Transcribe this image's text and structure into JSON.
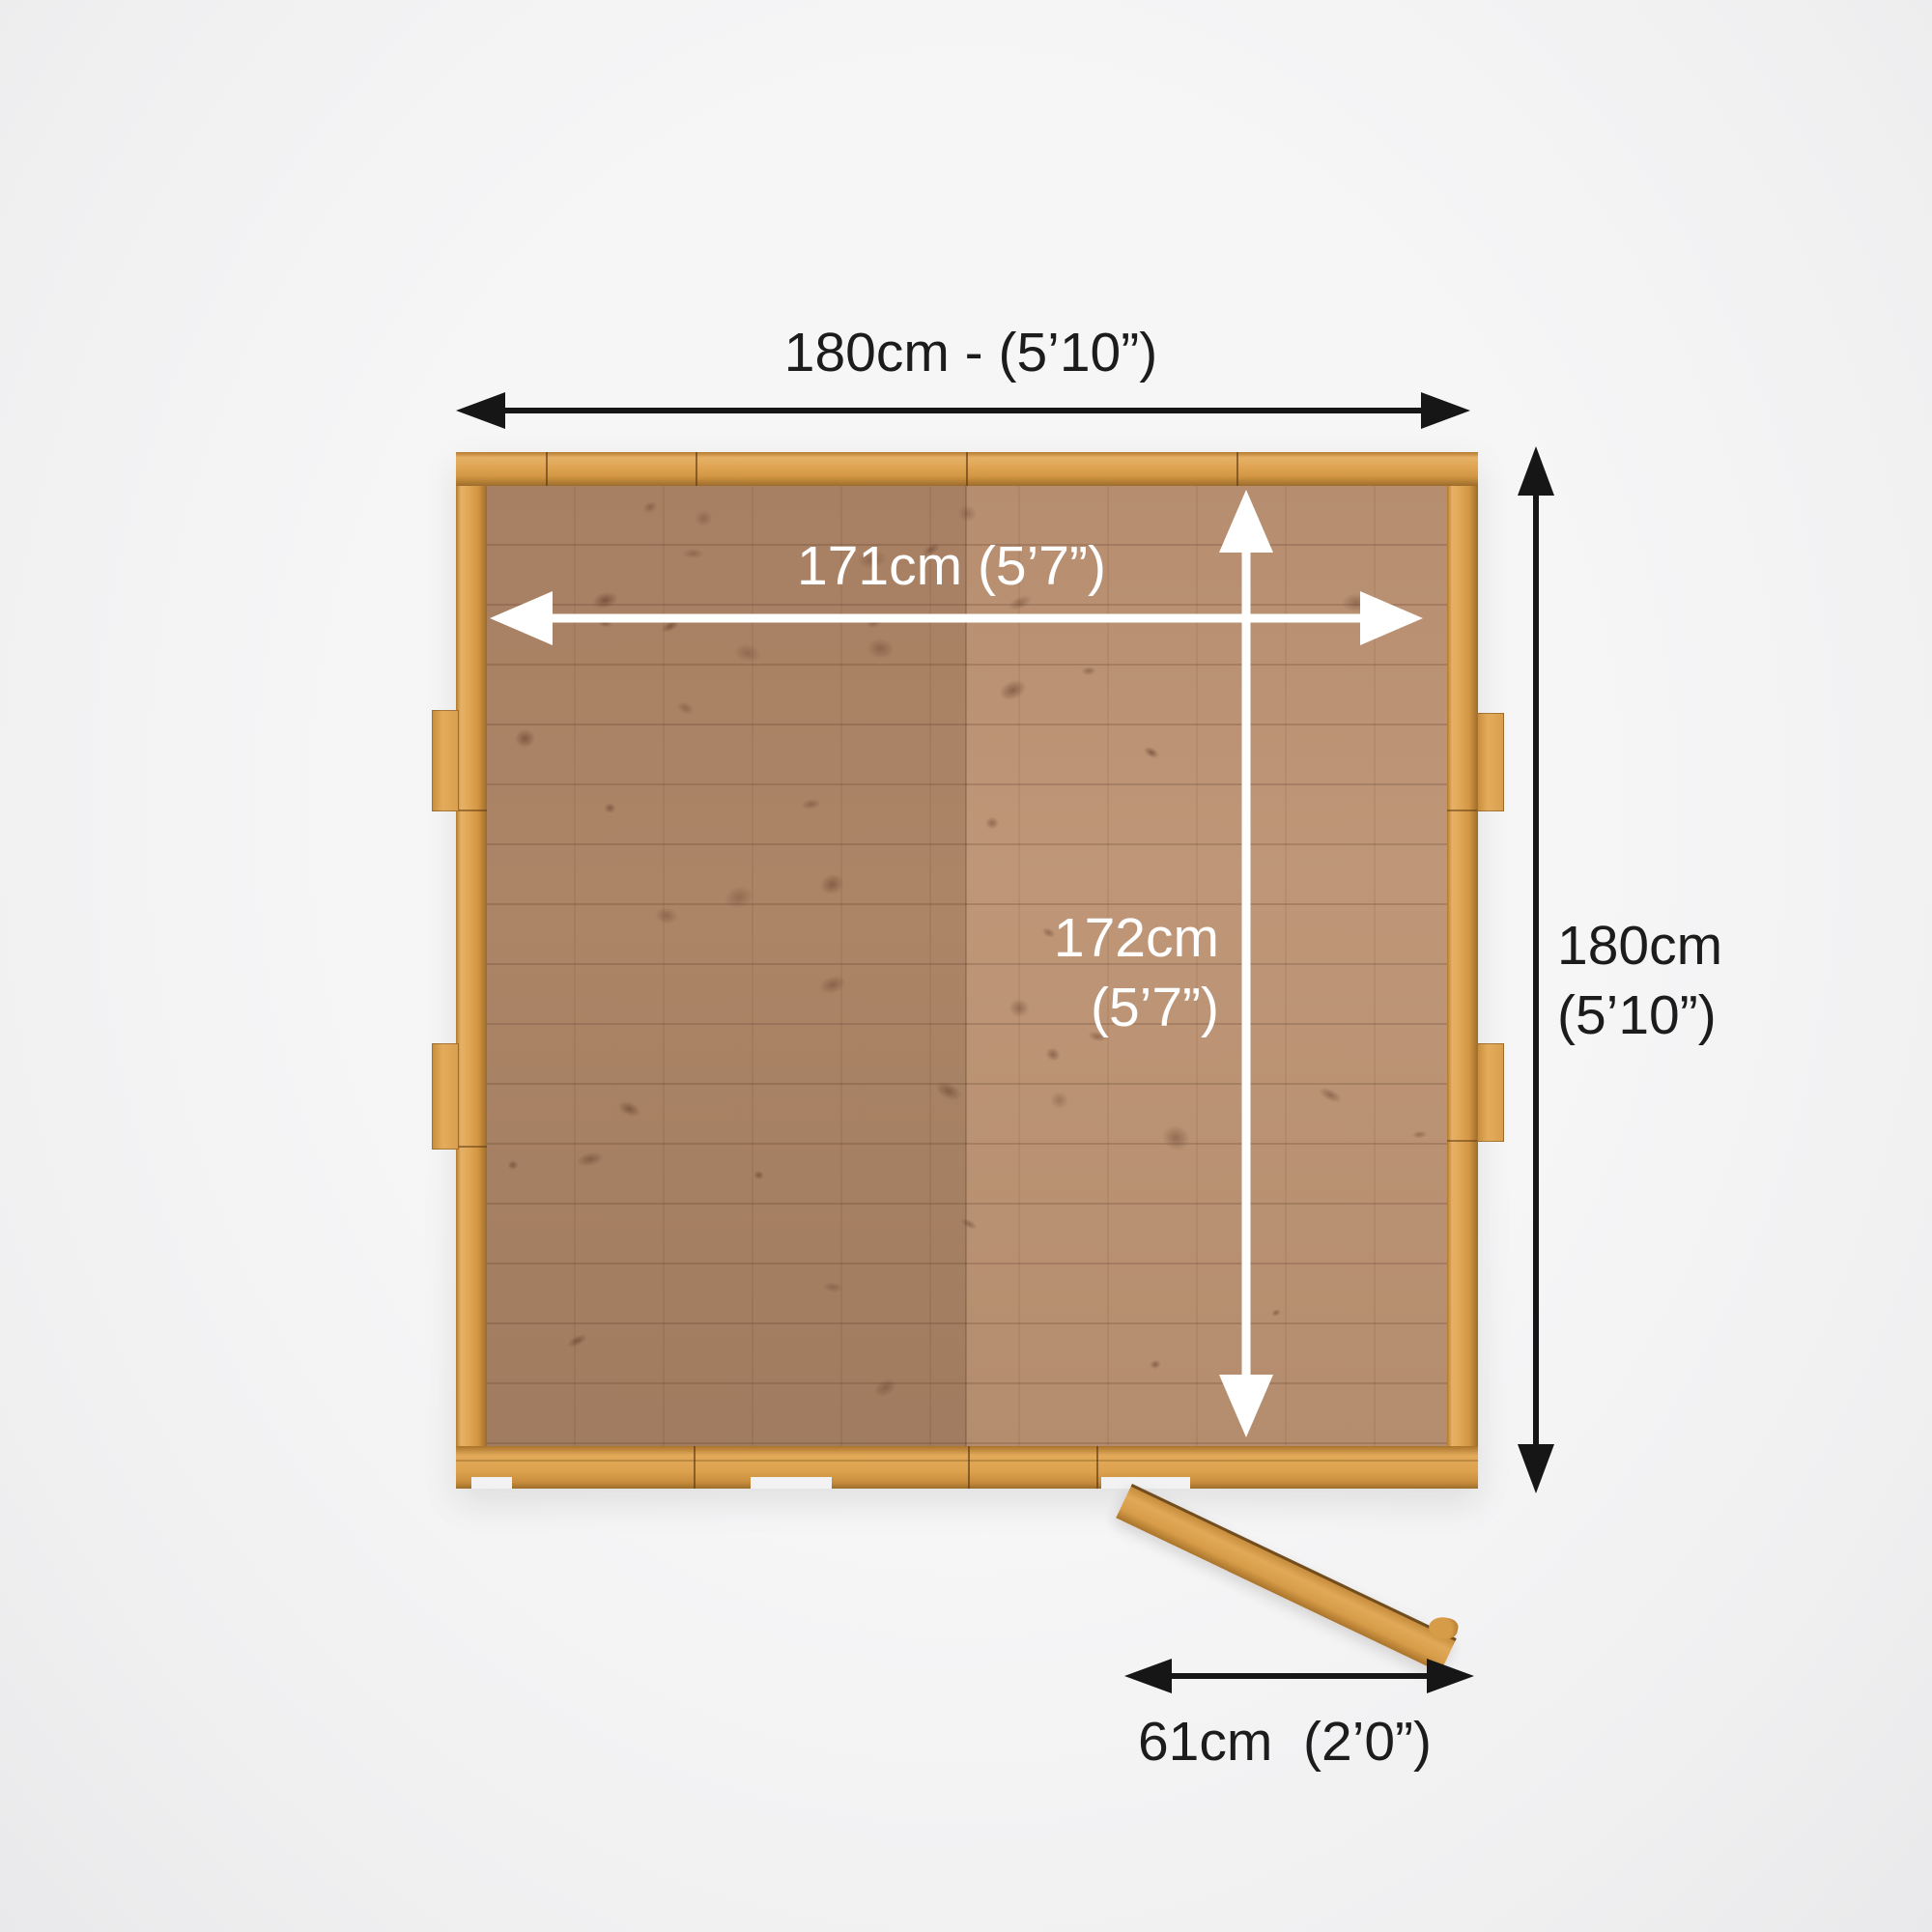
{
  "labels": {
    "outer_width": "180cm - (5’10”)",
    "outer_depth_line1": "180cm",
    "outer_depth_line2": "(5’10”)",
    "inner_width": "171cm (5’7”)",
    "inner_depth_line1": "172cm",
    "inner_depth_line2": "(5’7”)",
    "door_width": "61cm  (2’0”)"
  },
  "colors": {
    "background": "#f2f2f3",
    "frame_wood": "#dda24e",
    "floor_left": "#a57c5f",
    "floor_right": "#bd9474",
    "dimension_black": "#161616",
    "dimension_white": "#ffffff"
  }
}
